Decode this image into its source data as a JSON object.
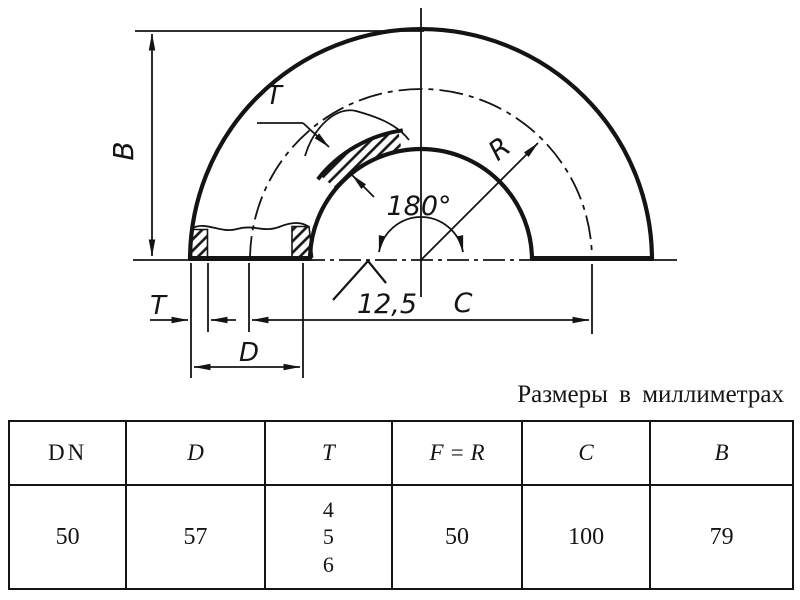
{
  "colors": {
    "ink": "#141414",
    "paper": "#ffffff"
  },
  "drawing": {
    "labels": {
      "b": "B",
      "t_section": "T",
      "t_end": "T",
      "d": "D",
      "c": "C",
      "r": "R",
      "angle": "180°",
      "roughness": "12,5"
    }
  },
  "caption": "Размеры в миллиметрах",
  "table": {
    "headers": [
      "DN",
      "D",
      "T",
      "F = R",
      "C",
      "B"
    ],
    "row": {
      "dn": "50",
      "d": "57",
      "t": [
        "4",
        "5",
        "6"
      ],
      "f_r": "50",
      "c": "100",
      "b": "79"
    }
  }
}
